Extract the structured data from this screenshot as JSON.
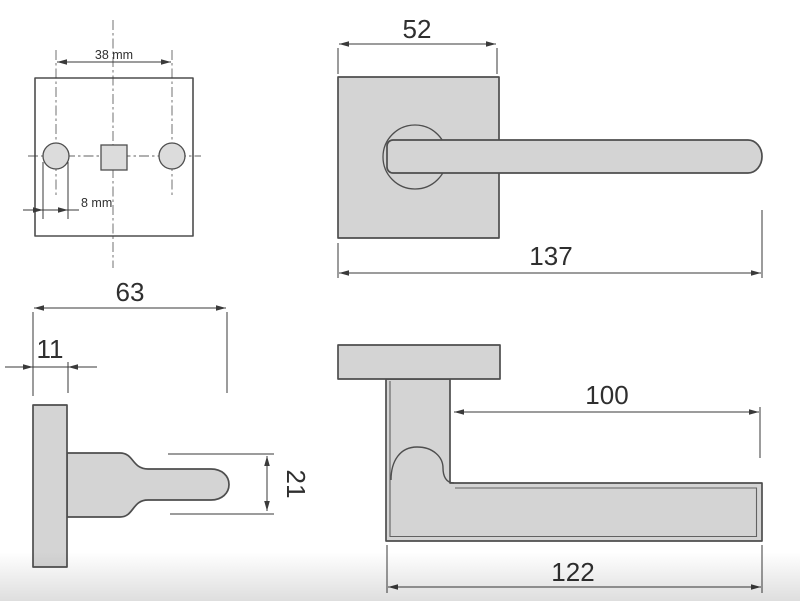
{
  "colors": {
    "background": "#ffffff",
    "fill": "#d4d4d4",
    "fill_light": "#dcdcdc",
    "outline": "#4e4e4e",
    "dimension": "#3a3a3a",
    "text": "#2f2f2f"
  },
  "views": {
    "back_plate": {
      "dims": {
        "hole_spacing": "38 mm",
        "hole_diameter": "8 mm"
      }
    },
    "front": {
      "dims": {
        "rose_width": "52",
        "overall_length": "137"
      }
    },
    "side": {
      "dims": {
        "projection": "63",
        "rose_thickness": "11",
        "lever_height": "21"
      }
    },
    "top": {
      "dims": {
        "grip_length": "100",
        "lever_length": "122"
      }
    }
  }
}
